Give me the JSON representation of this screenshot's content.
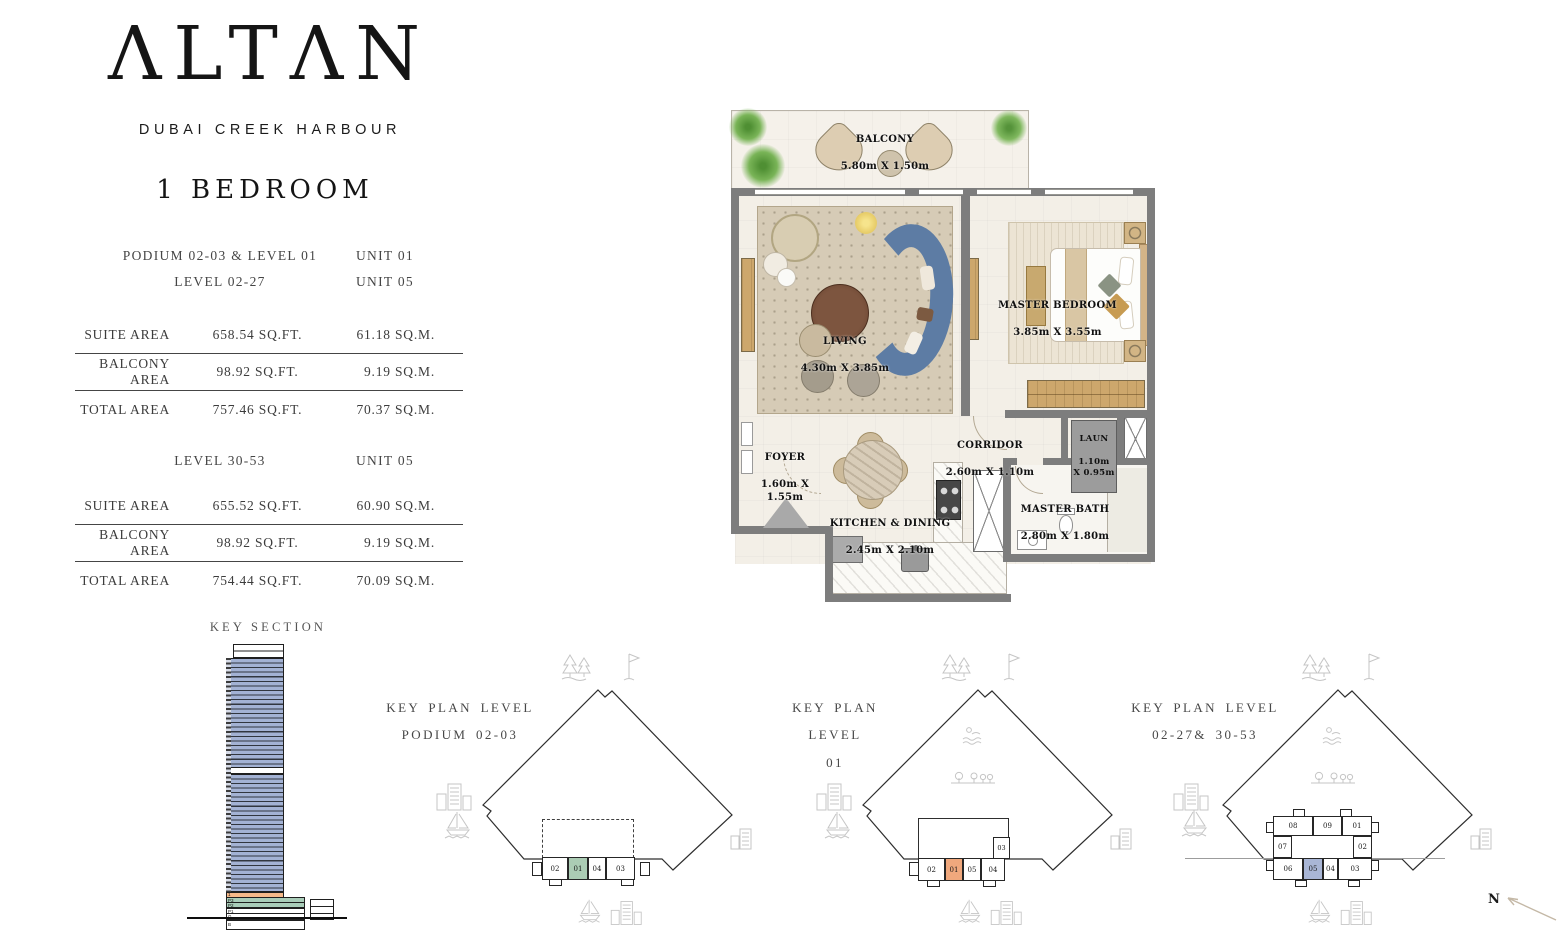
{
  "brand": {
    "logo": "ΛLTΛN",
    "subtitle": "DUBAI CREEK HARBOUR"
  },
  "unit_type": "1 BEDROOM",
  "spec_blocks": [
    {
      "headers": [
        {
          "level": "PODIUM 02-03 & LEVEL 01",
          "unit": "UNIT 01"
        },
        {
          "level": "LEVEL 02-27",
          "unit": "UNIT 05"
        }
      ],
      "rows": [
        {
          "label": "SUITE AREA",
          "sqft": "658.54 SQ.FT.",
          "sqm": "61.18 SQ.M."
        },
        {
          "label": "BALCONY AREA",
          "sqft": "98.92 SQ.FT.",
          "sqm": "9.19 SQ.M."
        },
        {
          "label": "TOTAL AREA",
          "sqft": "757.46 SQ.FT.",
          "sqm": "70.37 SQ.M."
        }
      ]
    },
    {
      "headers": [
        {
          "level": "LEVEL 30-53",
          "unit": "UNIT 05"
        }
      ],
      "rows": [
        {
          "label": "SUITE AREA",
          "sqft": "655.52 SQ.FT.",
          "sqm": "60.90 SQ.M."
        },
        {
          "label": "BALCONY AREA",
          "sqft": "98.92 SQ.FT.",
          "sqm": "9.19 SQ.M."
        },
        {
          "label": "TOTAL AREA",
          "sqft": "754.44 SQ.FT.",
          "sqm": "70.09 SQ.M."
        }
      ]
    }
  ],
  "key_section": {
    "title": "KEY SECTION",
    "floor_1": "1",
    "podium_floors": [
      "P3",
      "P2",
      "P1",
      "G",
      "B"
    ],
    "colors": {
      "tower": "#a3b2d4",
      "level_01": "#f6b98a",
      "podium": "#a9cdb9"
    }
  },
  "floor_plan": {
    "rooms": {
      "balcony": {
        "name": "BALCONY",
        "dims": "5.80m X 1.50m"
      },
      "living": {
        "name": "LIVING",
        "dims": "4.30m X 3.85m"
      },
      "master_bedroom": {
        "name": "MASTER BEDROOM",
        "dims": "3.85m X 3.55m"
      },
      "foyer": {
        "name": "FOYER",
        "dims": "1.60m X\n1.55m"
      },
      "corridor": {
        "name": "CORRIDOR",
        "dims": "2.60m X 1.10m"
      },
      "laundry": {
        "name": "LAUN",
        "dims": "1.10m\nX 0.95m"
      },
      "kitchen": {
        "name": "KITCHEN & DINING",
        "dims": "2.45m X 2.10m"
      },
      "master_bath": {
        "name": "MASTER BATH",
        "dims": "2.80m X 1.80m"
      }
    }
  },
  "key_plans": [
    {
      "title": "KEY PLAN LEVEL",
      "subtitle": "PODIUM 02-03",
      "highlight": {
        "unit": "01",
        "color": "#abccb4"
      },
      "units": {
        "u02": "02",
        "u01": "01",
        "u04": "04",
        "u03": "03"
      }
    },
    {
      "title": "KEY PLAN LEVEL",
      "subtitle": "01",
      "highlight": {
        "unit": "01",
        "color": "#f0a87d"
      },
      "units": {
        "u02": "02",
        "u01": "01",
        "u05": "05",
        "u04": "04",
        "u03": "03"
      }
    },
    {
      "title": "KEY PLAN LEVEL",
      "subtitle": "02-27& 30-53",
      "highlight": {
        "unit": "05",
        "color": "#a9b6d6"
      },
      "units": {
        "u08": "08",
        "u09": "09",
        "u01": "01",
        "u07": "07",
        "u02": "02",
        "u06": "06",
        "u05": "05",
        "u04": "04",
        "u03": "03"
      }
    }
  ],
  "compass": {
    "label": "N"
  }
}
